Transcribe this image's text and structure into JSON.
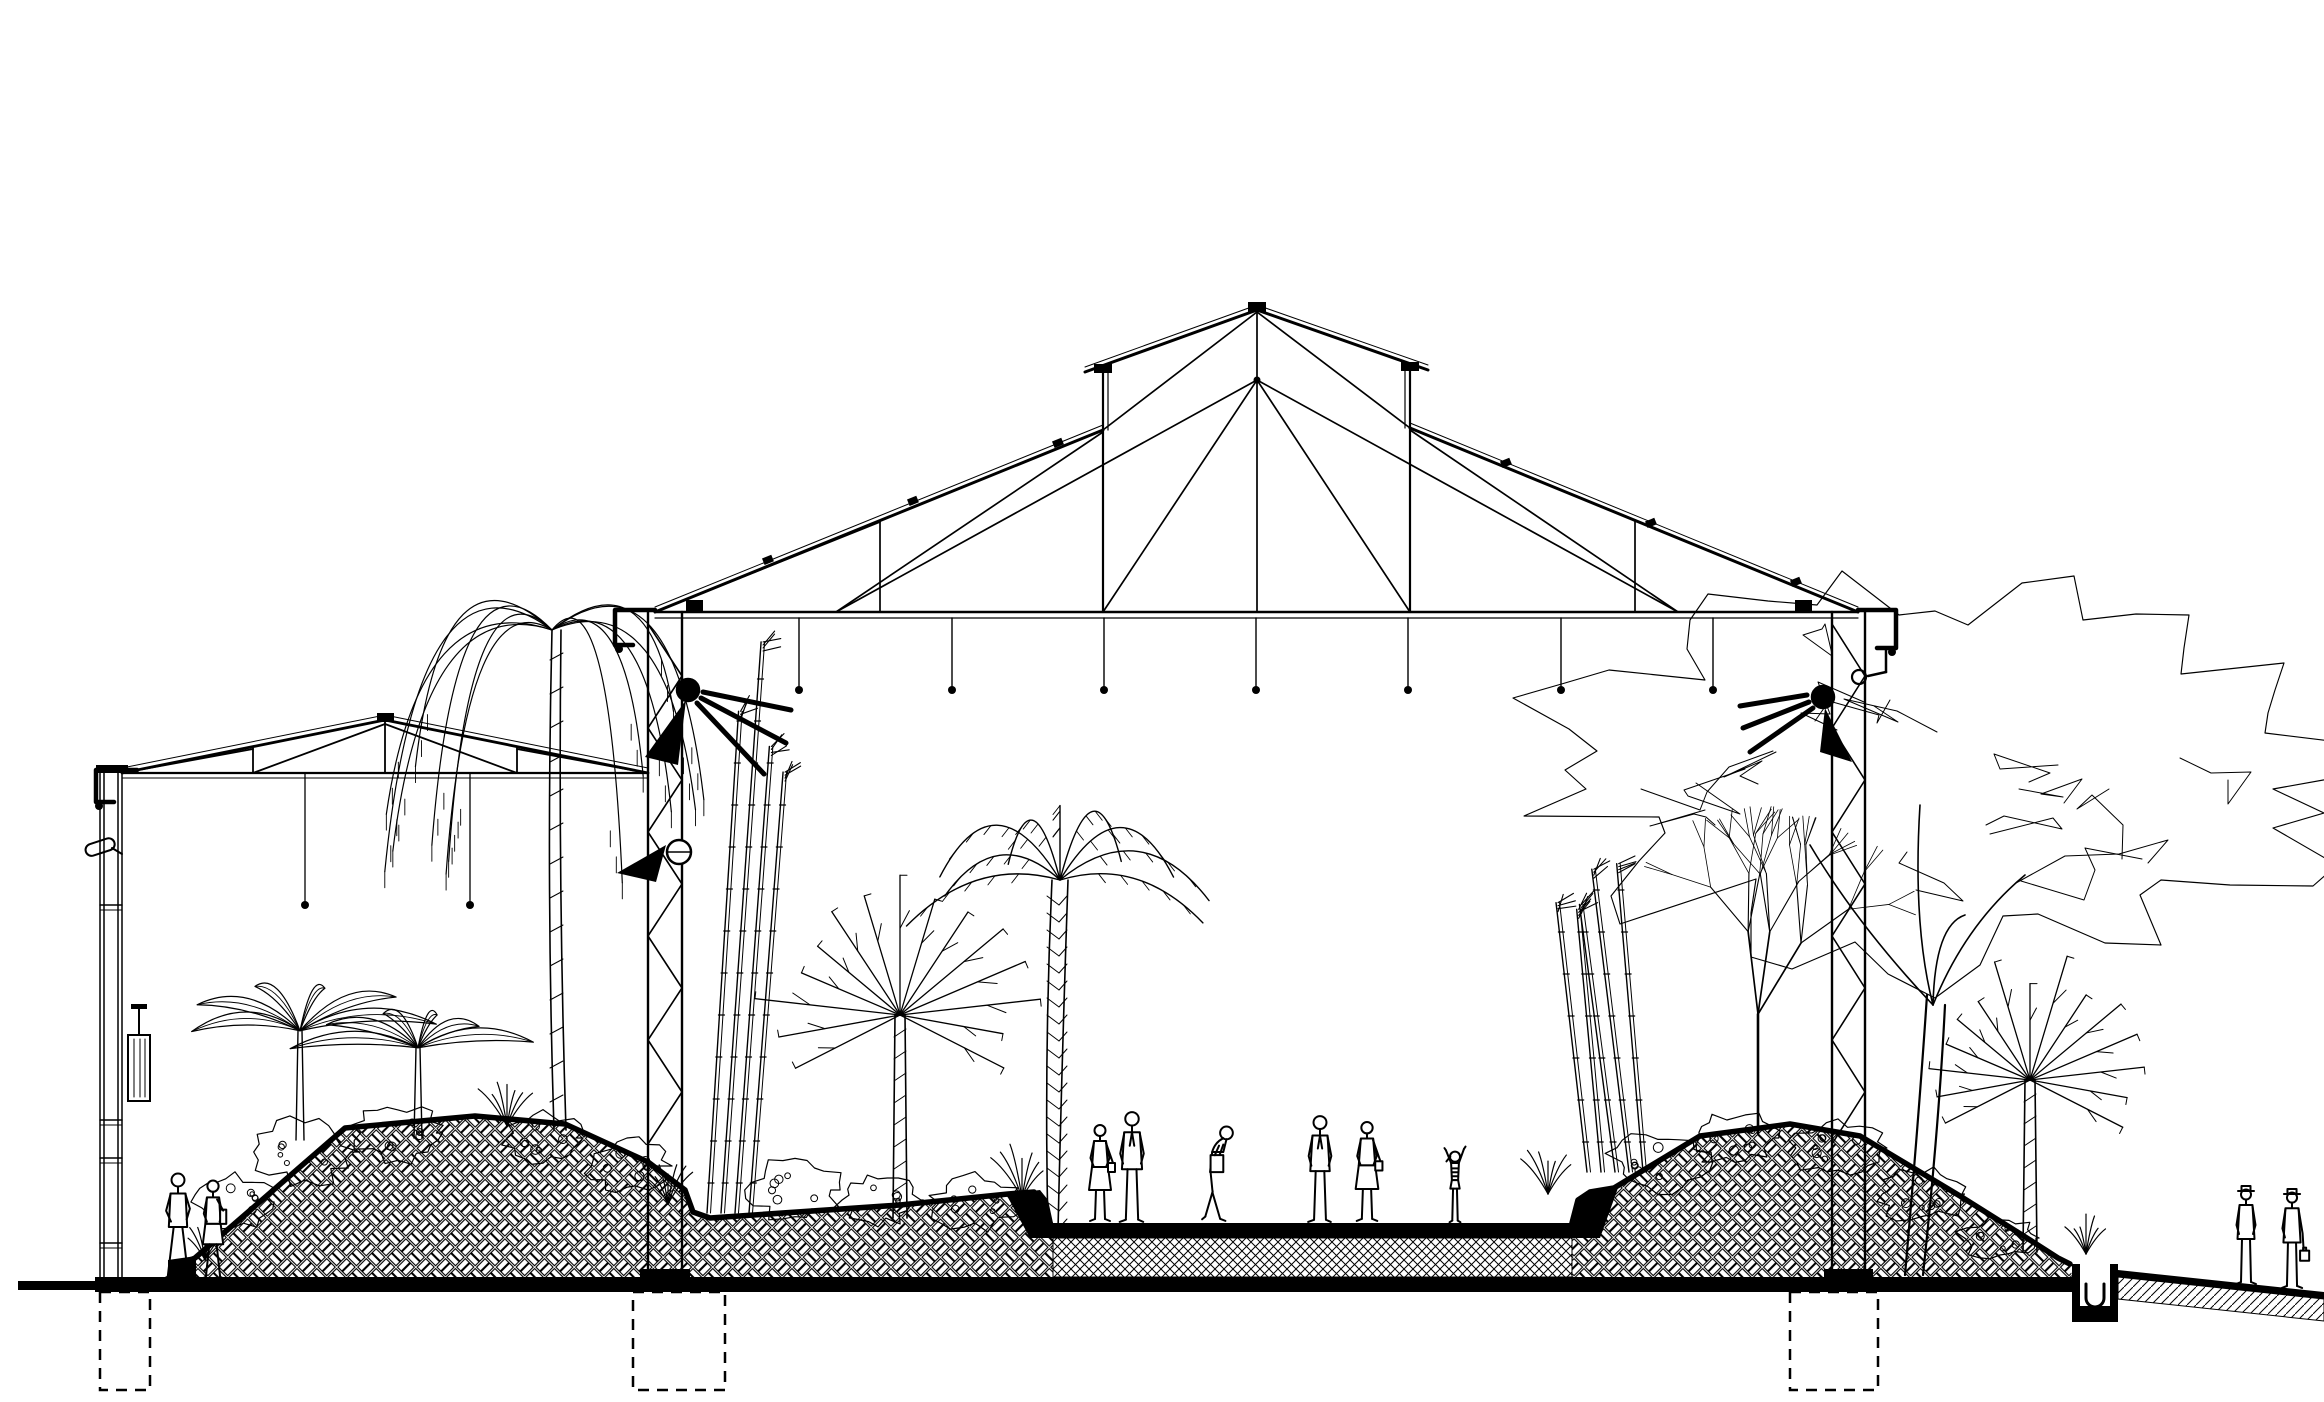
{
  "document": {
    "kind": "architectural section drawing",
    "subject": "greenhouse conservatory cross-section with planted berms, central walkway and visitors",
    "style": "black ink line drawing on white paper",
    "ink": "#000000",
    "paper": "#ffffff"
  },
  "canvas": {
    "width": 2324,
    "height": 1402
  },
  "ground": {
    "slab": {
      "x1": 95,
      "x2": 2072,
      "yTop": 1277,
      "yBot": 1292
    },
    "left_stub": {
      "x1": 18,
      "x2": 95,
      "yTop": 1281,
      "yBot": 1290
    },
    "walkway": {
      "x1": 1053,
      "x2": 1572,
      "surfaceY": 1223,
      "bandH": 15,
      "baseBotY": 1277
    },
    "berm_left": [
      [
        175,
        1277
      ],
      [
        175,
        1266
      ],
      [
        195,
        1258
      ],
      [
        345,
        1128
      ],
      [
        475,
        1116
      ],
      [
        565,
        1124
      ],
      [
        648,
        1162
      ],
      [
        685,
        1190
      ],
      [
        693,
        1212
      ],
      [
        710,
        1218
      ],
      [
        900,
        1205
      ],
      [
        1008,
        1194
      ],
      [
        1034,
        1192
      ],
      [
        1044,
        1206
      ],
      [
        1050,
        1223
      ],
      [
        1053,
        1230
      ],
      [
        1053,
        1277
      ]
    ],
    "berm_right": [
      [
        1572,
        1277
      ],
      [
        1572,
        1223
      ],
      [
        1578,
        1200
      ],
      [
        1590,
        1192
      ],
      [
        1614,
        1188
      ],
      [
        1700,
        1136
      ],
      [
        1790,
        1124
      ],
      [
        1860,
        1136
      ],
      [
        1960,
        1196
      ],
      [
        2030,
        1240
      ],
      [
        2058,
        1258
      ],
      [
        2070,
        1264
      ],
      [
        2072,
        1277
      ]
    ],
    "curb_left_toe": [
      [
        168,
        1277
      ],
      [
        168,
        1260
      ],
      [
        196,
        1256
      ],
      [
        196,
        1277
      ]
    ],
    "curb_walk_left": [
      [
        1006,
        1194
      ],
      [
        1040,
        1190
      ],
      [
        1048,
        1200
      ],
      [
        1053,
        1223
      ],
      [
        1053,
        1238
      ],
      [
        1030,
        1238
      ]
    ],
    "curb_walk_right": [
      [
        1572,
        1238
      ],
      [
        1572,
        1223
      ],
      [
        1577,
        1203
      ],
      [
        1590,
        1192
      ],
      [
        1618,
        1188
      ],
      [
        1600,
        1238
      ]
    ],
    "foundations": [
      [
        100,
        1292,
        50,
        98
      ],
      [
        633,
        1292,
        92,
        98
      ],
      [
        1790,
        1292,
        88,
        98
      ]
    ],
    "drain": {
      "x": 2072,
      "y": 1264,
      "w": 46,
      "h": 58
    },
    "right_strip": {
      "edge": [
        [
          2118,
          1270
        ],
        [
          2324,
          1292
        ],
        [
          2324,
          1299
        ],
        [
          2118,
          1277
        ]
      ],
      "hatch": [
        [
          2118,
          1277
        ],
        [
          2324,
          1299
        ],
        [
          2324,
          1321
        ],
        [
          2118,
          1299
        ]
      ]
    }
  },
  "small_building": {
    "wall": {
      "xs": [
        100,
        104,
        118,
        122
      ],
      "top": 772,
      "bottom": 1277,
      "rungs": [
        905,
        1120,
        1158,
        1243
      ]
    },
    "truss": {
      "eaveL": [
        122,
        773
      ],
      "eaveR": [
        648,
        773
      ],
      "ridge": [
        385,
        720
      ],
      "webs": [
        [
          385,
          722,
          385,
          773
        ],
        [
          253,
          748,
          253,
          773
        ],
        [
          517,
          748,
          517,
          773
        ],
        [
          253,
          773,
          385,
          724
        ],
        [
          517,
          773,
          385,
          724
        ],
        [
          122,
          773,
          253,
          749
        ],
        [
          648,
          773,
          517,
          749
        ]
      ],
      "rods": [
        [
          305,
          905
        ],
        [
          470,
          905
        ]
      ]
    },
    "gutter": {
      "path": [
        [
          137,
          770
        ],
        [
          96,
          770
        ],
        [
          96,
          802
        ],
        [
          114,
          802
        ]
      ],
      "dot": [
        99,
        806
      ]
    },
    "ridge_cap": [
      377,
      713,
      17,
      9
    ],
    "heater": {
      "x": 128,
      "y": 1035,
      "w": 22,
      "h": 66,
      "pipeTop": 1008
    },
    "lamp": {
      "x": 84,
      "y": 846,
      "w": 30,
      "h": 12,
      "rot": -18
    }
  },
  "hall": {
    "eaveL": [
      655,
      612
    ],
    "eaveR": [
      1858,
      612
    ],
    "apex": [
      1257,
      310
    ],
    "chordY2": 618,
    "clerestory": {
      "postL": 1103,
      "postR": 1410,
      "topL": 372,
      "topR": 370,
      "baseL": 430,
      "baseR": 428,
      "roofExtL": 1085,
      "roofExtR": 1428
    },
    "webs": [
      [
        1257,
        312,
        1257,
        612
      ],
      [
        1103,
        372,
        1103,
        612
      ],
      [
        1410,
        370,
        1410,
        612
      ],
      [
        1257,
        380,
        1103,
        612
      ],
      [
        1257,
        380,
        1410,
        612
      ],
      [
        1257,
        380,
        836,
        612
      ],
      [
        1257,
        380,
        1678,
        612
      ],
      [
        1257,
        312,
        1103,
        430
      ],
      [
        1257,
        312,
        1410,
        428
      ],
      [
        836,
        612,
        1103,
        432
      ],
      [
        1678,
        612,
        1410,
        430
      ],
      [
        655,
        612,
        880,
        522
      ],
      [
        1858,
        612,
        1635,
        520
      ],
      [
        880,
        522,
        880,
        612
      ],
      [
        1635,
        520,
        1635,
        612
      ]
    ],
    "columns": {
      "left": [
        648,
        682
      ],
      "right": [
        1832,
        1865
      ],
      "top": 612,
      "bottom": 1277,
      "lat_step": 52,
      "lat_top": 624,
      "lat_bot": 1170
    },
    "gutter_left": {
      "path": [
        [
          655,
          610
        ],
        [
          615,
          610
        ],
        [
          615,
          645
        ],
        [
          633,
          645
        ]
      ],
      "dot": [
        619,
        649
      ]
    },
    "gutter_right": {
      "path": [
        [
          1858,
          610
        ],
        [
          1896,
          610
        ],
        [
          1896,
          648
        ],
        [
          1877,
          648
        ]
      ],
      "dot": [
        1892,
        652
      ]
    },
    "downpipe": {
      "segs": [
        [
          1886,
          648,
          1886,
          672
        ],
        [
          1886,
          672,
          1868,
          676
        ]
      ],
      "elbow": [
        1859,
        677,
        7
      ]
    },
    "rods": {
      "xs": [
        799,
        952,
        1104,
        1256,
        1408,
        1561,
        1713
      ],
      "y1": 618,
      "y2": 690
    },
    "ticks": [
      [
        770,
        565
      ],
      [
        915,
        506
      ],
      [
        1060,
        448
      ],
      [
        1508,
        468
      ],
      [
        1653,
        528
      ],
      [
        1798,
        587
      ]
    ],
    "eave_blocks": [
      [
        686,
        600
      ],
      [
        1795,
        600
      ]
    ],
    "apex_cap": [
      1248,
      302,
      18,
      10
    ],
    "clere_caps": [
      [
        1094,
        364,
        18,
        9
      ],
      [
        1401,
        362,
        18,
        9
      ]
    ]
  },
  "lights": [
    {
      "id": "floodlight-left-column",
      "cx": 688,
      "cy": 690,
      "r": 11,
      "filled": true,
      "cone": [
        [
          686,
          700
        ],
        [
          645,
          757
        ],
        [
          678,
          765
        ]
      ],
      "rays": [
        [
          697,
          703,
          764,
          774
        ],
        [
          701,
          698,
          786,
          743
        ],
        [
          703,
          692,
          791,
          710
        ]
      ]
    },
    {
      "id": "spotlight-left-column-lower",
      "cx": 679,
      "cy": 852,
      "r": 12,
      "filled": false,
      "cone": [
        [
          666,
          845
        ],
        [
          617,
          873
        ],
        [
          656,
          882
        ]
      ],
      "rays": []
    },
    {
      "id": "floodlight-right-column",
      "cx": 1823,
      "cy": 697,
      "r": 11,
      "filled": true,
      "cone": [
        [
          1825,
          708
        ],
        [
          1852,
          762
        ],
        [
          1820,
          752
        ]
      ],
      "rays": [
        [
          1813,
          708,
          1750,
          752
        ],
        [
          1809,
          702,
          1743,
          728
        ],
        [
          1807,
          695,
          1740,
          706
        ]
      ]
    }
  ],
  "plants": [
    {
      "type": "flower",
      "x": 205,
      "y": 1260,
      "h": 46
    },
    {
      "type": "bush",
      "x": 235,
      "y": 1202,
      "rx": 42,
      "ry": 28
    },
    {
      "type": "banana",
      "x": 300,
      "y": 1140,
      "s": 1.15
    },
    {
      "type": "bush",
      "x": 305,
      "y": 1152,
      "rx": 50,
      "ry": 32
    },
    {
      "type": "banana",
      "x": 418,
      "y": 1138,
      "s": 0.95
    },
    {
      "type": "bush",
      "x": 398,
      "y": 1133,
      "rx": 44,
      "ry": 28
    },
    {
      "type": "flower",
      "x": 507,
      "y": 1126,
      "h": 52
    },
    {
      "type": "bush",
      "x": 543,
      "y": 1138,
      "rx": 40,
      "ry": 25
    },
    {
      "type": "weeping",
      "x": 560,
      "top": 575,
      "spread": 170,
      "baseY": 1130
    },
    {
      "type": "bush",
      "x": 627,
      "y": 1166,
      "rx": 40,
      "ry": 26
    },
    {
      "type": "flower",
      "x": 668,
      "y": 1204,
      "h": 50
    },
    {
      "type": "bamboo",
      "x": 735,
      "y": 1213,
      "h": 560,
      "n": 4,
      "lean": 0.05
    },
    {
      "type": "bush",
      "x": 795,
      "y": 1190,
      "rx": 46,
      "ry": 30
    },
    {
      "type": "fanpalm",
      "x": 900,
      "cy": 1015,
      "spread": 135,
      "baseY": 1218
    },
    {
      "type": "bush",
      "x": 878,
      "y": 1200,
      "rx": 40,
      "ry": 25
    },
    {
      "type": "datepalm",
      "x": 1060,
      "cy": 880,
      "spread": 155,
      "baseY": 1230
    },
    {
      "type": "bush",
      "x": 975,
      "y": 1203,
      "rx": 44,
      "ry": 27
    },
    {
      "type": "flower",
      "x": 1022,
      "y": 1198,
      "h": 56
    },
    {
      "type": "flower",
      "x": 1548,
      "y": 1194,
      "h": 50
    },
    {
      "type": "bamboo",
      "x": 1622,
      "y": 1172,
      "h": 300,
      "n": 5,
      "lean": -0.07
    },
    {
      "type": "bush",
      "x": 1658,
      "y": 1162,
      "rx": 48,
      "ry": 29
    },
    {
      "type": "bush",
      "x": 1735,
      "y": 1138,
      "rx": 42,
      "ry": 25
    },
    {
      "type": "baretree",
      "x": 1758,
      "y": 1133,
      "h": 360
    },
    {
      "type": "bush",
      "x": 1838,
      "y": 1148,
      "rx": 46,
      "ry": 27
    },
    {
      "type": "bush",
      "x": 1922,
      "y": 1194,
      "rx": 44,
      "ry": 27
    },
    {
      "type": "canopy",
      "cx": 1935,
      "cy": 770,
      "rx": 420,
      "ry": 205,
      "trunkX": 1905,
      "trunkY": 1275
    },
    {
      "type": "fanpalm",
      "x": 2030,
      "cy": 1080,
      "spread": 120,
      "baseY": 1252
    },
    {
      "type": "bush",
      "x": 2000,
      "y": 1238,
      "rx": 40,
      "ry": 21
    },
    {
      "type": "flower",
      "x": 2086,
      "y": 1254,
      "h": 40
    }
  ],
  "figures": [
    {
      "pose": "walkM",
      "x": 178,
      "footY": 1281,
      "h": 108,
      "label": "man walking"
    },
    {
      "pose": "walkF",
      "x": 213,
      "footY": 1281,
      "h": 102,
      "label": "woman walking"
    },
    {
      "pose": "standF",
      "x": 1100,
      "footY": 1223,
      "h": 100,
      "label": "woman standing"
    },
    {
      "pose": "standM",
      "x": 1132,
      "footY": 1223,
      "h": 112,
      "label": "man standing"
    },
    {
      "pose": "bendM",
      "x": 1218,
      "footY": 1223,
      "h": 106,
      "label": "man leaning with bag"
    },
    {
      "pose": "standM",
      "x": 1320,
      "footY": 1223,
      "h": 108,
      "label": "man standing"
    },
    {
      "pose": "standF",
      "x": 1367,
      "footY": 1223,
      "h": 103,
      "label": "woman with handbag"
    },
    {
      "pose": "child",
      "x": 1455,
      "footY": 1223,
      "h": 78,
      "label": "child with raised arms"
    },
    {
      "pose": "hatM",
      "x": 2246,
      "footY": 1285,
      "h": 100,
      "label": "man with hat"
    },
    {
      "pose": "hatM2",
      "x": 2292,
      "footY": 1289,
      "h": 101,
      "label": "man with hat and case"
    }
  ]
}
